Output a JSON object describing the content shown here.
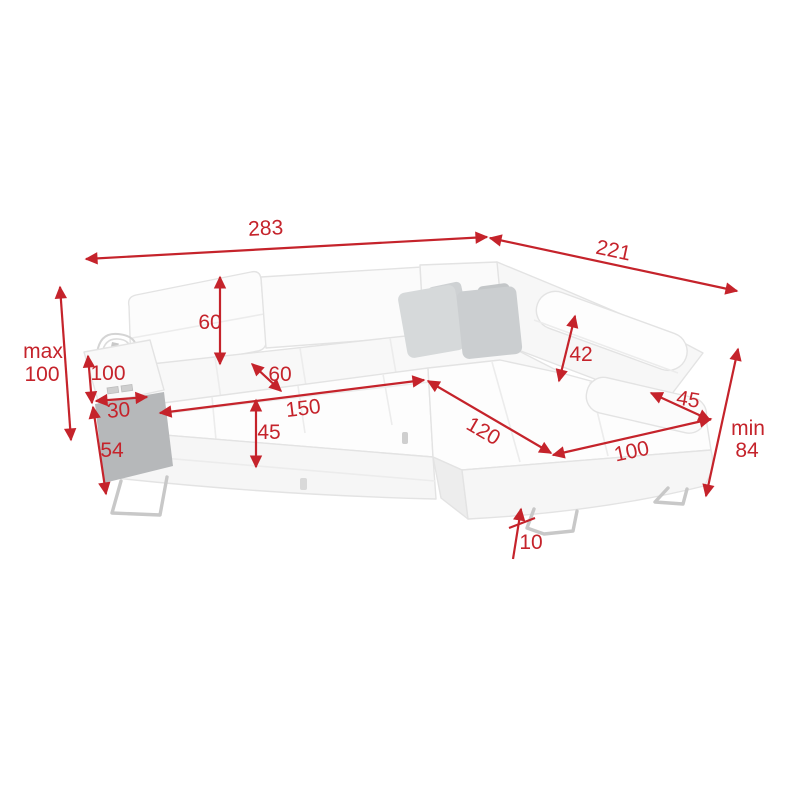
{
  "diagram": {
    "kind": "corner-sofa-dimension-diagram",
    "background": "#ffffff"
  },
  "dimensions": {
    "overall_width": "283",
    "overall_depth": "221",
    "max_height_prefix": "max",
    "max_height": "100",
    "backrest_height": "60",
    "armrest_height": "100",
    "armrest_top_width": "30",
    "armrest_side_height": "54",
    "seat_cushion_depth": "60",
    "seat_width": "150",
    "seat_height": "45",
    "headrest_height": "42",
    "right_armrest_width": "45",
    "chaise_length": "120",
    "chaise_width": "100",
    "min_height_prefix": "min",
    "min_height": "84",
    "leg_height": "10"
  },
  "colors": {
    "dimension_red": "#c5232b",
    "sofa_white": "#fdfdfd",
    "sofa_outline": "#e3e3e3",
    "pillow_gray_light": "#d6d9da",
    "pillow_gray_dark": "#cbced0",
    "armrest_side_panel": "#b6b8ba",
    "metal_leg": "#c8c8c8"
  }
}
